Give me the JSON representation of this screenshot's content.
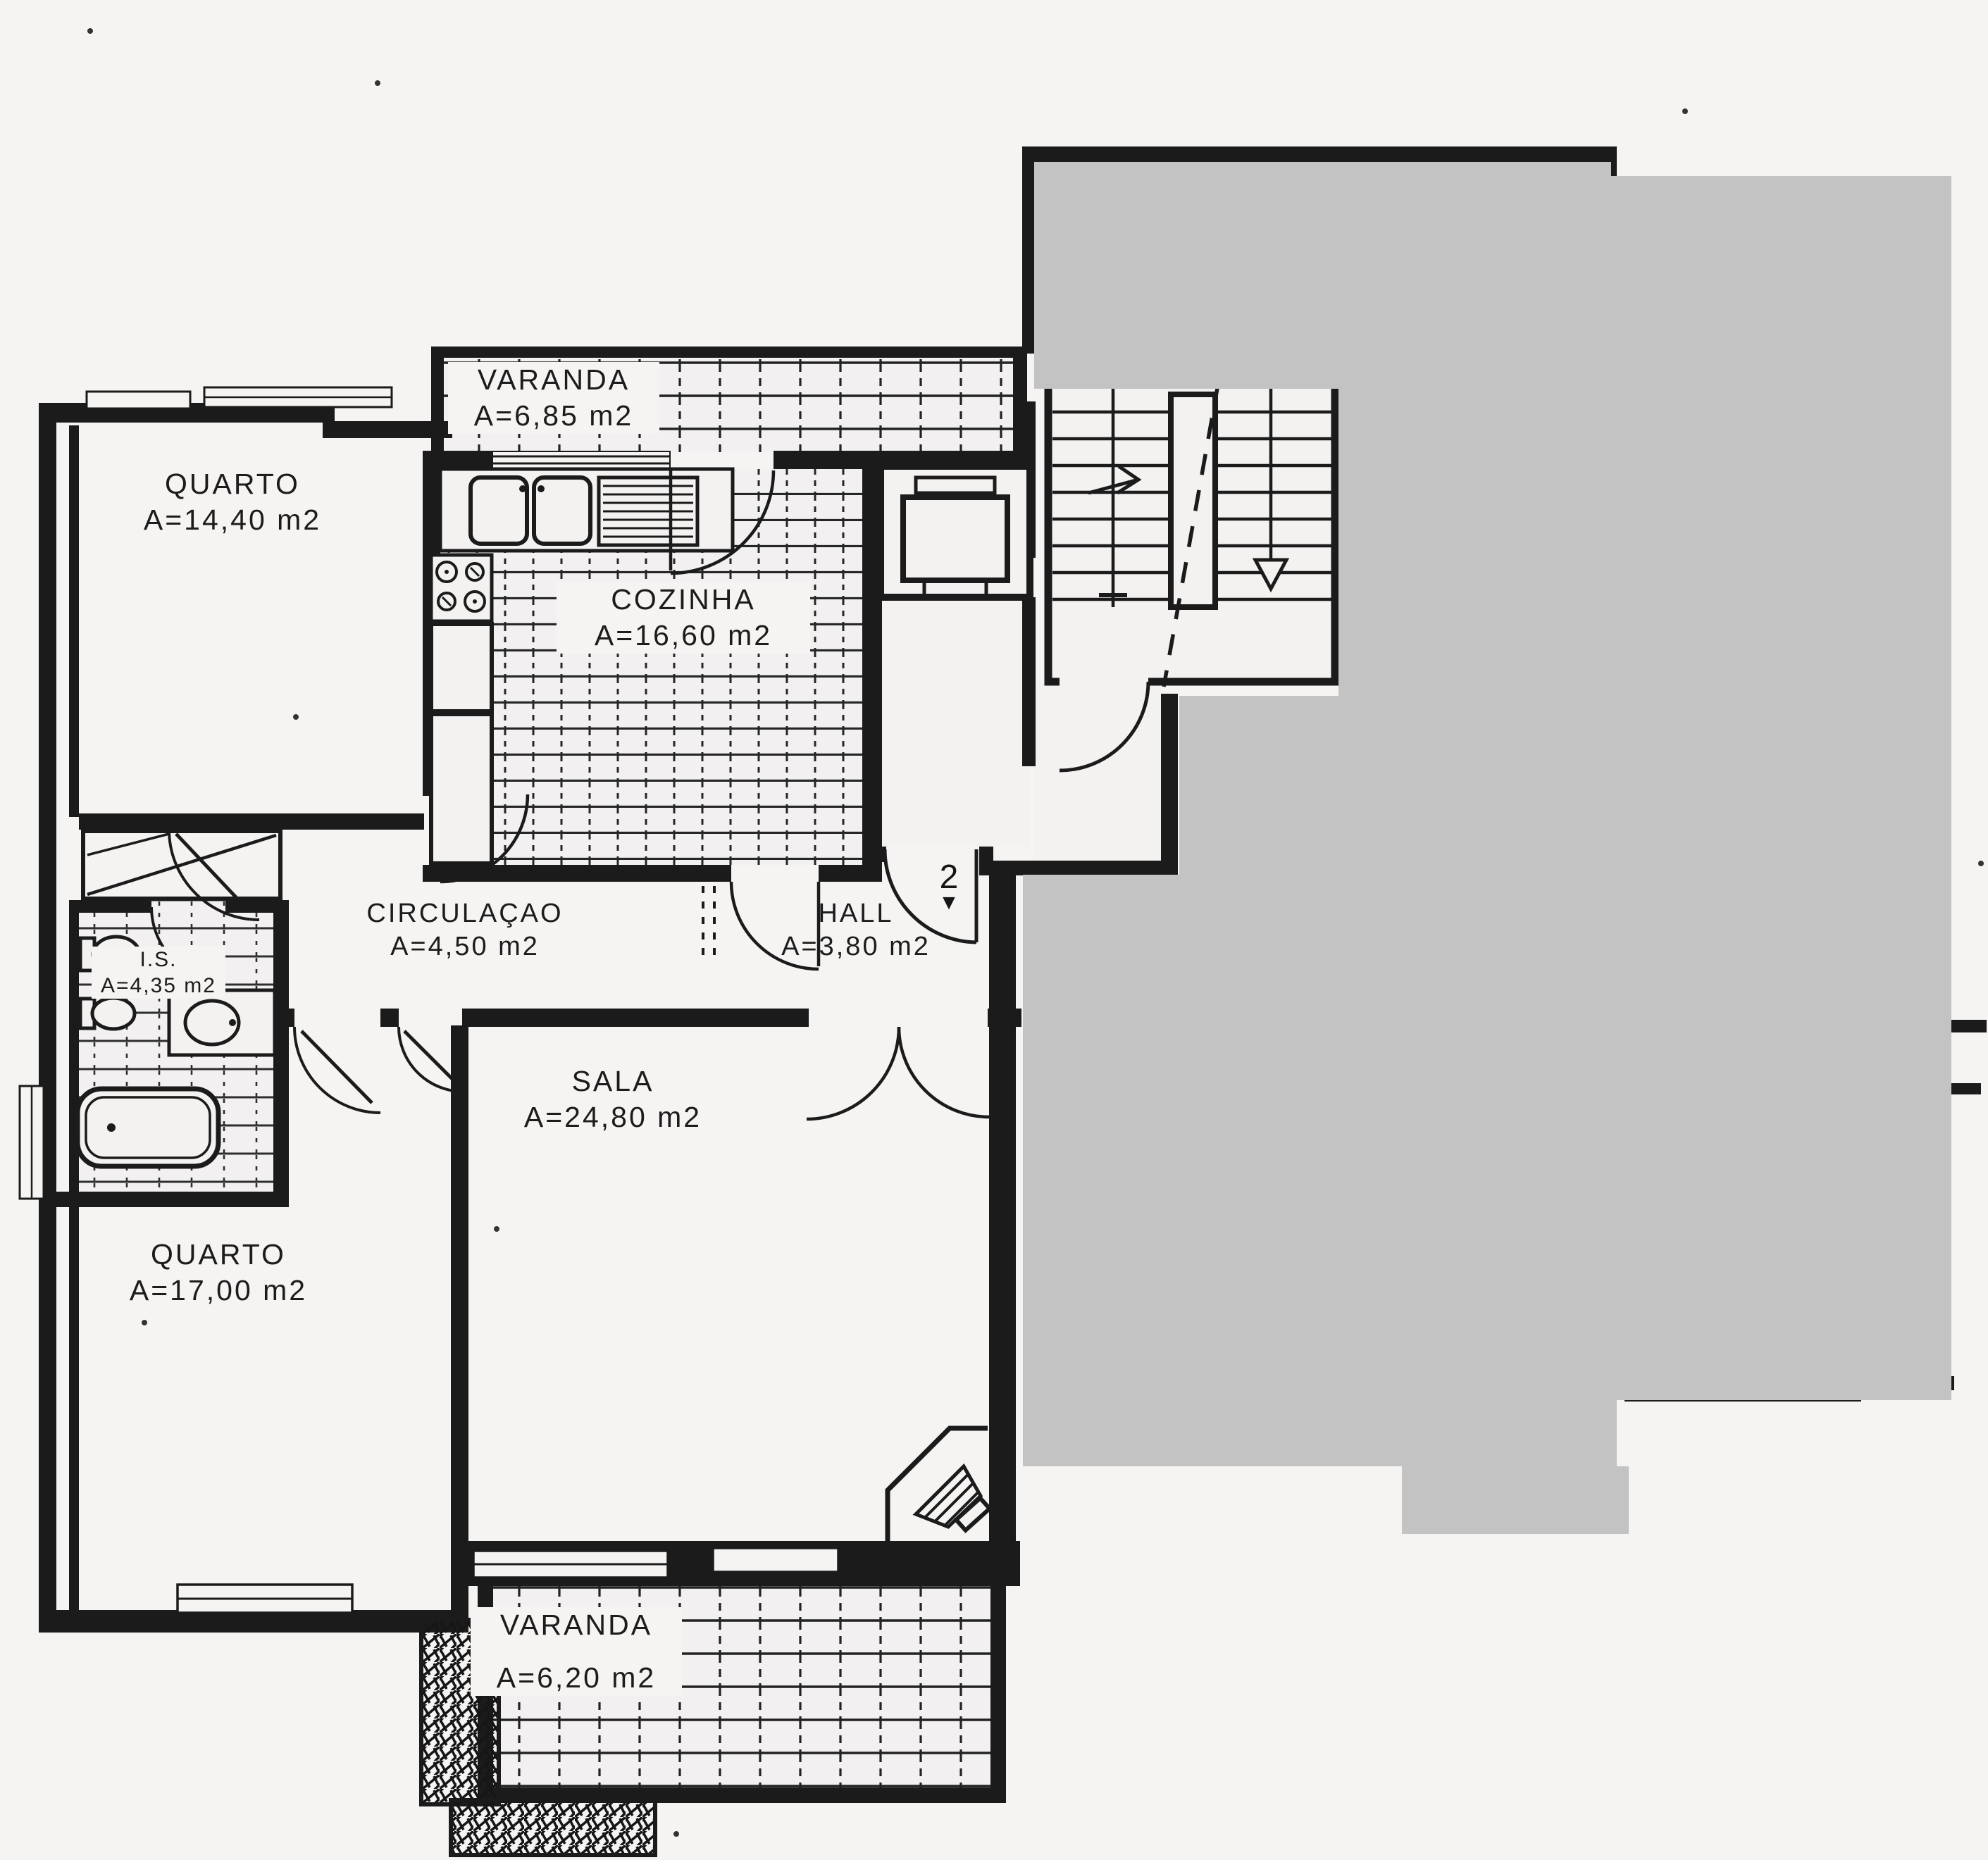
{
  "plan": {
    "kind_label": "apartment floor plan (scanned)",
    "rooms": [
      {
        "id": "varanda_top",
        "name": "VARANDA",
        "area_label": "A=6,85  m2"
      },
      {
        "id": "quarto_top",
        "name": "QUARTO",
        "area_label": "A=14,40  m2"
      },
      {
        "id": "cozinha",
        "name": "COZINHA",
        "area_label": "A=16,60  m2"
      },
      {
        "id": "circulacao",
        "name": "CIRCULAÇAO",
        "area_label": "A=4,50  m2"
      },
      {
        "id": "hall",
        "name": "HALL",
        "area_label": "A=3,80  m2"
      },
      {
        "id": "is",
        "name": "I.S.",
        "area_label": "A=4,35  m2"
      },
      {
        "id": "sala",
        "name": "SALA",
        "area_label": "A=24,80  m2"
      },
      {
        "id": "quarto_bottom",
        "name": "QUARTO",
        "area_label": "A=17,00  m2"
      },
      {
        "id": "varanda_bottom",
        "name": "VARANDA",
        "area_label": "A=6,20  m2"
      }
    ],
    "annotations": {
      "entrance_number": "2",
      "entrance_arrow": "▼"
    },
    "colors": {
      "paper": "#f6f4f3",
      "ink": "#1b1b1b",
      "mask_gray": "#c3c3c3"
    }
  }
}
